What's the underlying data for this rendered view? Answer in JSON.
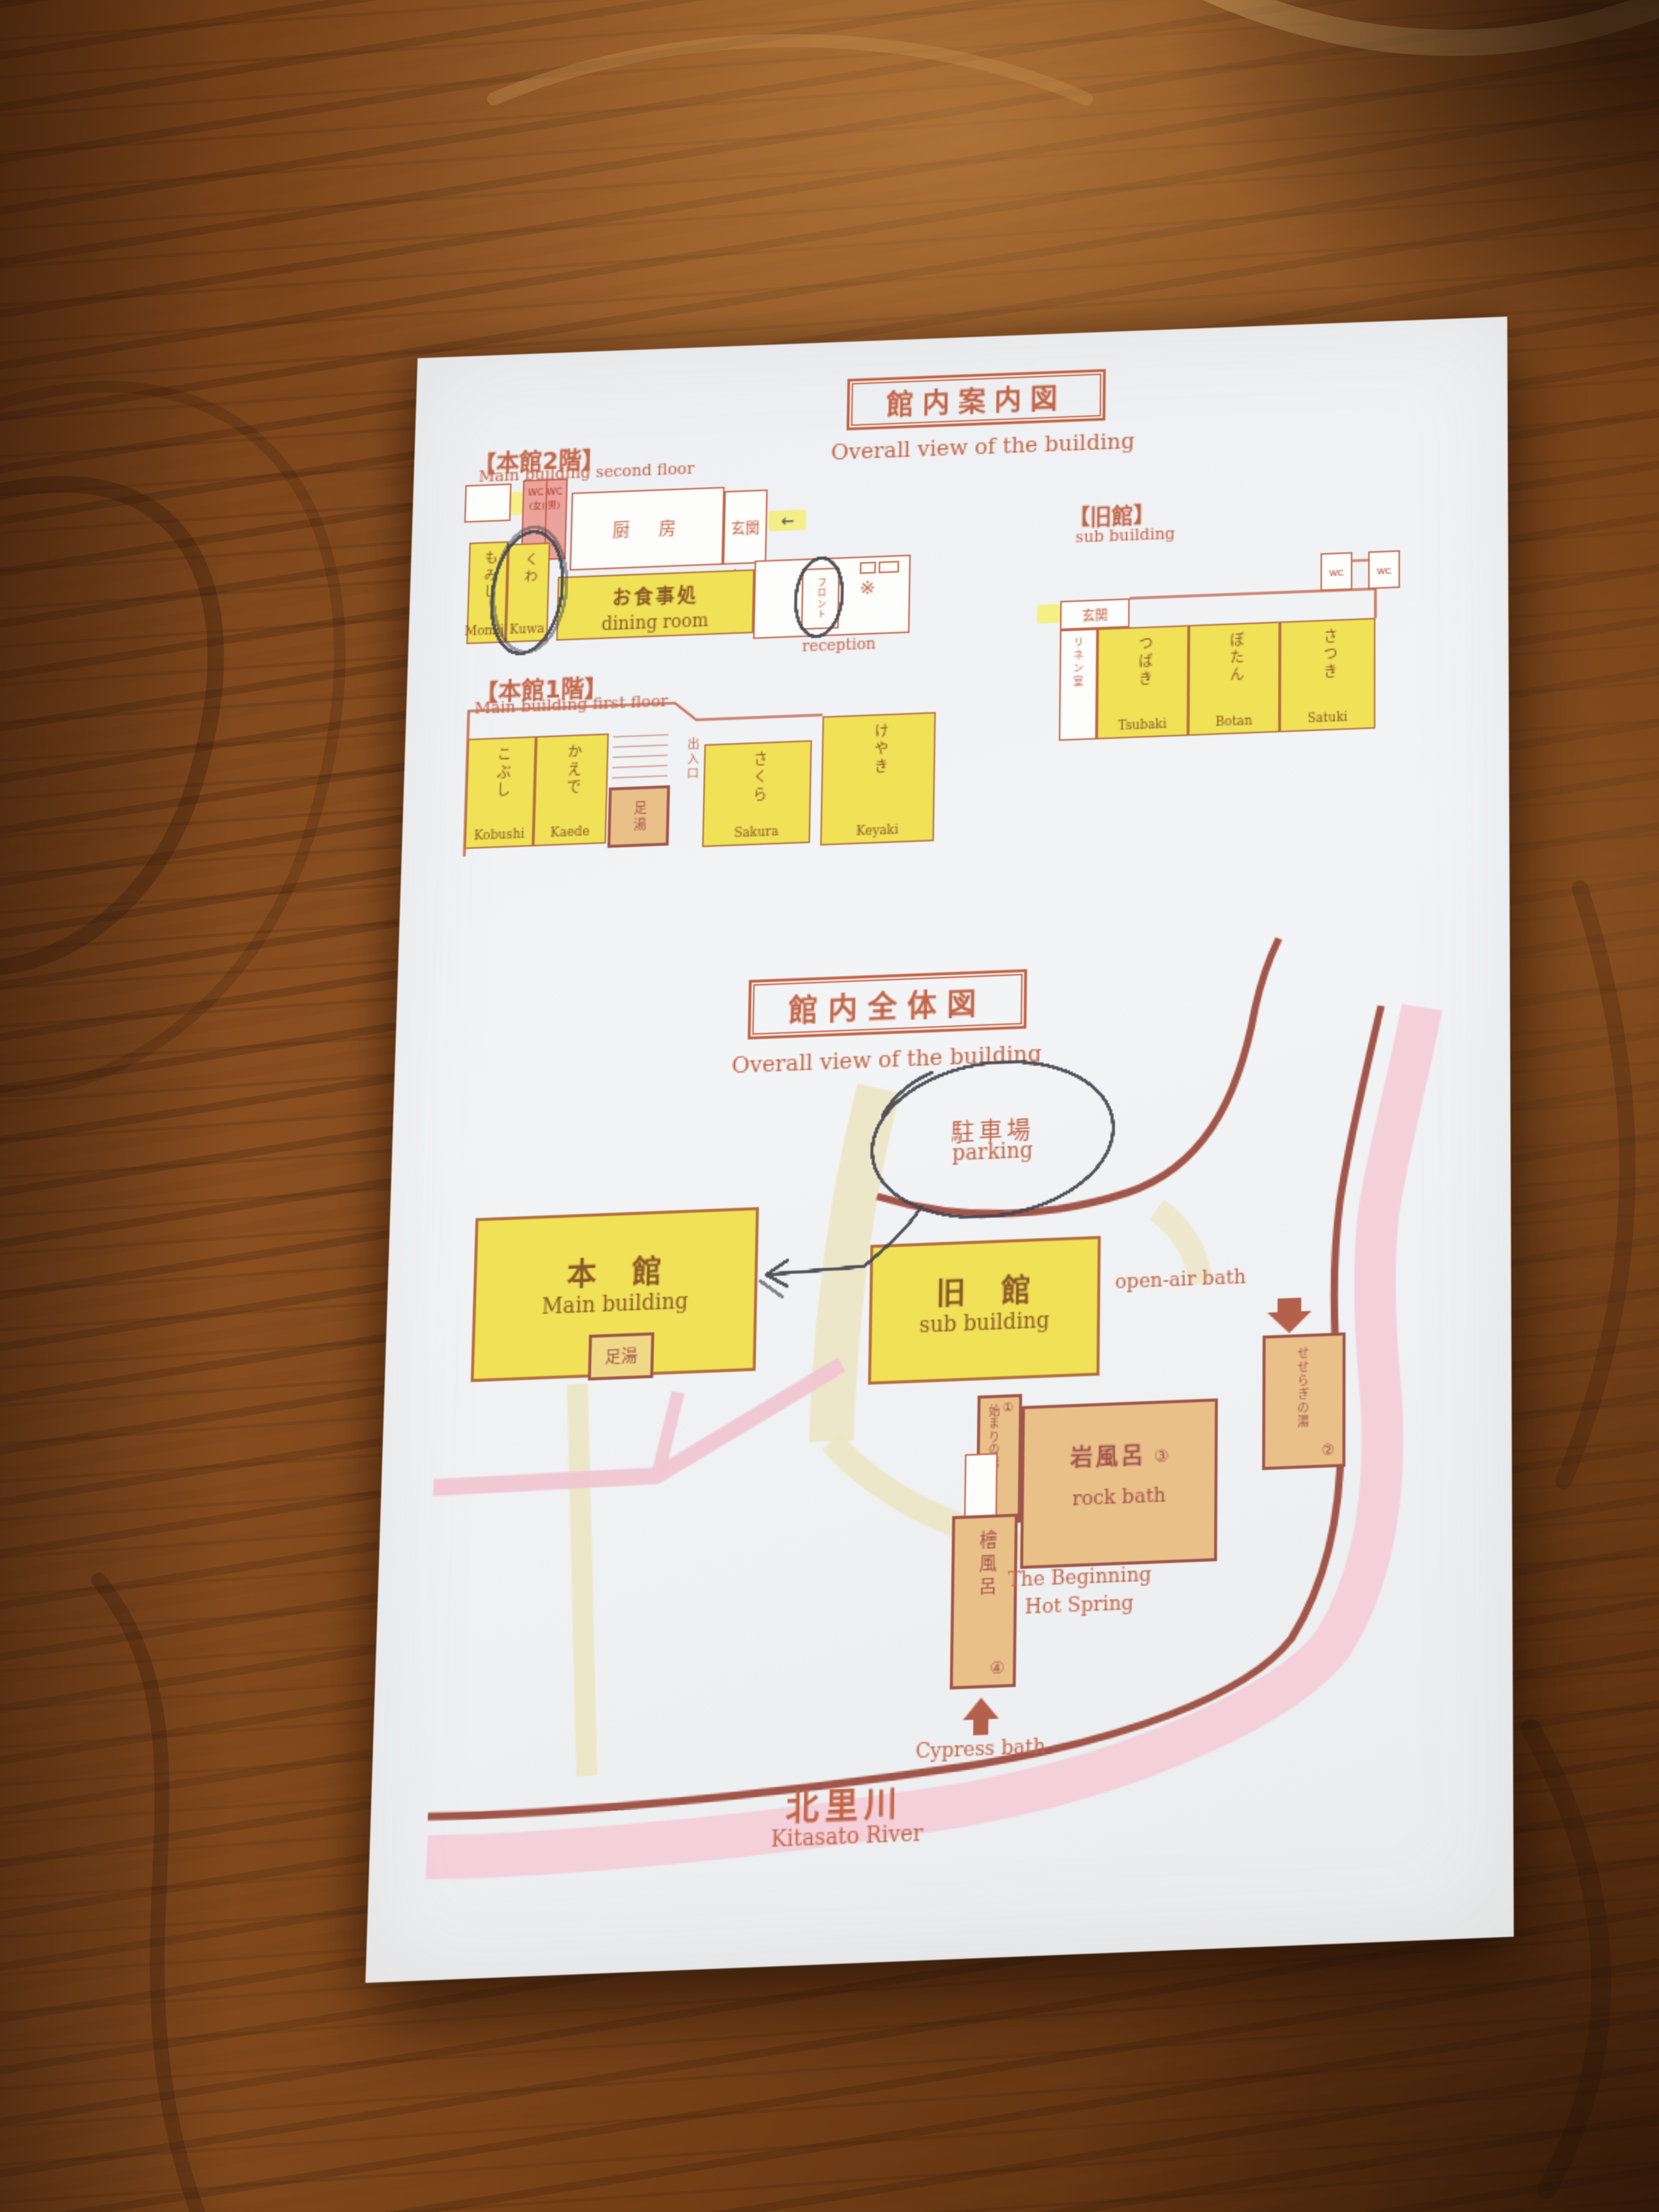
{
  "guide_title": {
    "jp": "館内案内図",
    "en": "Overall view of the building"
  },
  "map_title": {
    "jp": "館内全体図",
    "en": "Overall view of the building"
  },
  "floor2": {
    "header": "【本館2階】",
    "subheader": "Main building second floor",
    "wc_top": "WC WC",
    "wc_bottom": "(女)(男)",
    "kitchen": "厨　房",
    "entrance_jp": "玄関",
    "entrance_en": "entrance",
    "arrow_left": "←",
    "front_jp": "フロント",
    "reception": "reception",
    "lobby_mark": "※",
    "rooms": [
      {
        "jp": "もみじ",
        "en": "Momiji"
      },
      {
        "jp": "くわ",
        "en": "Kuwa"
      }
    ],
    "dining_jp": "お食事処",
    "dining_en": "dining room"
  },
  "annex": {
    "header": "【旧館】",
    "subheader": "sub building",
    "wc_left": "WC",
    "wc_right": "WC",
    "entrance": "玄関",
    "linen": "リネン室",
    "rooms": [
      {
        "jp": "つばき",
        "en": "Tsubaki"
      },
      {
        "jp": "ぼたん",
        "en": "Botan"
      },
      {
        "jp": "さつき",
        "en": "Satuki"
      }
    ]
  },
  "floor1": {
    "header": "【本館1階】",
    "subheader": "Main building first floor",
    "exit": "出入口",
    "footbath": "足湯",
    "rooms": [
      {
        "jp": "こぶし",
        "en": "Kobushi"
      },
      {
        "jp": "かえで",
        "en": "Kaede"
      },
      {
        "jp": "さくら",
        "en": "Sakura"
      },
      {
        "jp": "けやき",
        "en": "Keyaki"
      }
    ]
  },
  "sitemap": {
    "parking_jp": "駐車場",
    "parking_en": "parking",
    "main_jp": "本　館",
    "main_en": "Main building",
    "main_footbath": "足湯",
    "annex_jp": "旧　館",
    "annex_en": "sub building",
    "open_air": "open-air bath",
    "hajimari_jp": "始まりの湯",
    "hajimari_num": "①",
    "seseragi_jp": "せせらぎの湯",
    "seseragi_num": "②",
    "rock_jp": "岩風呂",
    "rock_num": "③",
    "rock_en": "rock bath",
    "hinoki_jp": "檜風呂",
    "hinoki_num": "④",
    "beginning_1": "The Beginning",
    "beginning_2": "Hot Spring",
    "cypress": "Cypress bath",
    "river_jp": "北里川",
    "river_en": "Kitasato River"
  },
  "colors": {
    "print": "#c26649",
    "print_dark": "#a8543f",
    "room_yellow": "#f0e156",
    "bath_orange": "#eac089",
    "river_pink": "#f3cdd8",
    "road": "#a2564a",
    "wc_pink": "#eaa49b",
    "highlighter": "#f4ee72",
    "pen": "#45454e",
    "path_cream": "#ece5c4",
    "path_pink": "#f0c6d2",
    "paper": "#eff1f3"
  }
}
